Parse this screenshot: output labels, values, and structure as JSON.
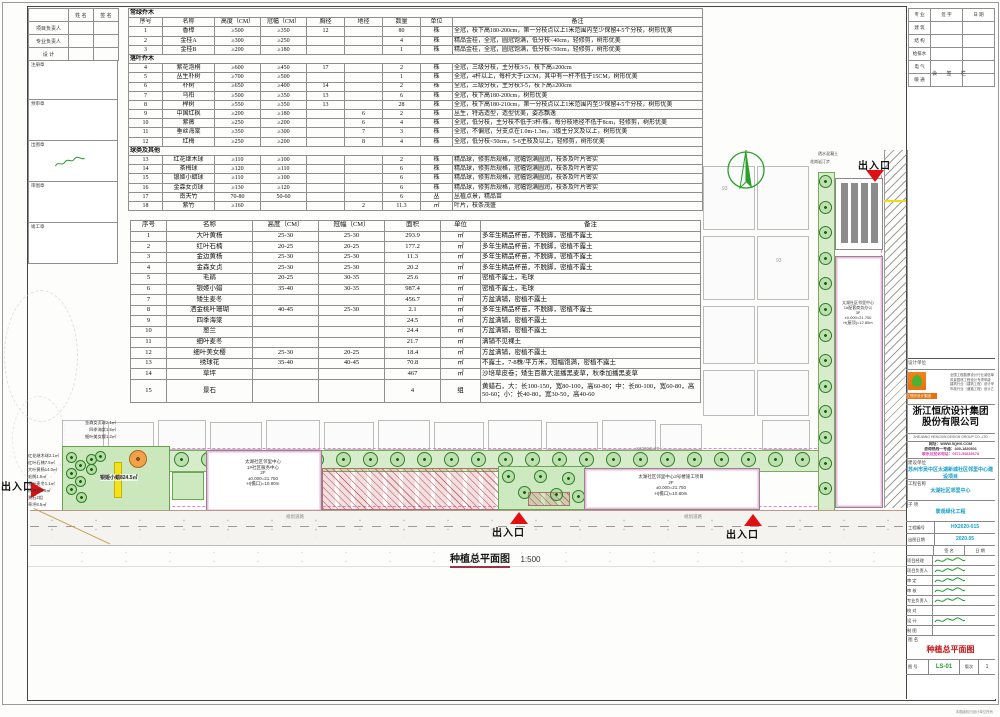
{
  "sheet": {
    "left_panel": {
      "headers": [
        "姓 名",
        "签 名"
      ],
      "rows": [
        "项目负责人",
        "专业负责人",
        "设  计"
      ],
      "stamps": [
        "注册章",
        "预审章",
        "出图章",
        "审图章",
        "竣工章"
      ]
    },
    "plant_table": {
      "headers": [
        "序号",
        "名称",
        "高度（CM）",
        "冠幅（CM）",
        "胸径",
        "地径",
        "数量",
        "单位",
        "备注"
      ],
      "sections": [
        {
          "title": "常绿乔木",
          "rows": [
            [
              "1",
              "香樟",
              "≥500",
              "≥350",
              "12",
              "",
              "80",
              "株",
              "全冠，枝下高180-200cm，第一分枝点以上1米范围内至少保留4-5个分枝，树形优美"
            ],
            [
              "2",
              "金桂A",
              "≥300",
              "≥250",
              "",
              "",
              "4",
              "株",
              "精品金桂，全冠，圆冠饱满，低分枝<40cm，轻修剪，树形优美"
            ],
            [
              "3",
              "金桂B",
              "≥200",
              "≥180",
              "",
              "",
              "1",
              "株",
              "精品金桂，全冠，圆冠饱满，低分枝<50cm，轻修剪，树形优美"
            ]
          ]
        },
        {
          "title": "落叶乔木",
          "rows": [
            [
              "4",
              "紫花泡桐",
              "≥600",
              "≥450",
              "17",
              "",
              "2",
              "株",
              "全冠，三级分枝，主分枝3-5，枝下高≥200cm"
            ],
            [
              "5",
              "丛生朴树",
              "≥700",
              "≥500",
              "",
              "",
              "1",
              "株",
              "全冠，4杆以上，每杆大于12CM，其中有一杆不低于15CM，树形优美"
            ],
            [
              "6",
              "朴树",
              "≥650",
              "≥400",
              "14",
              "",
              "2",
              "株",
              "全冠，三级分枝，主分枝3-5，枝下高≥200cm"
            ],
            [
              "7",
              "乌桕",
              "≥500",
              "≥350",
              "13",
              "",
              "6",
              "株",
              "全冠，枝下高180-200cm，树形优美"
            ],
            [
              "8",
              "榉树",
              "≥550",
              "≥350",
              "13",
              "",
              "28",
              "株",
              "全冠，枝下高180-210cm，第一分枝点以上1米范围内至少保留4-5个分枝，树形优美"
            ],
            [
              "9",
              "中国红枫",
              "≥200",
              "≥180",
              "",
              "6",
              "2",
              "株",
              "丛生，特选造型，造型优美，姿态飘逸"
            ],
            [
              "10",
              "紫薇",
              "≥250",
              "≥200",
              "",
              "6",
              "4",
              "株",
              "全冠，低分枝，主分枝不低于3杆/株，每分枝地径不低于8cm，轻修剪，树形优美"
            ],
            [
              "11",
              "垂丝海棠",
              "≥350",
              "≥300",
              "",
              "7",
              "3",
              "株",
              "全冠，不偏冠，分支点在1.0m-1.3m，3级主分叉及以上，树形优美"
            ],
            [
              "12",
              "红梅",
              "≥250",
              "≥200",
              "",
              "8",
              "4",
              "株",
              "全冠，低分枝<50cm，5-6主枝及以上，轻修剪，树形优美"
            ]
          ]
        },
        {
          "title": "球类及其他",
          "rows": [
            [
              "13",
              "红花继木球",
              "≥110",
              "≥100",
              "",
              "",
              "2",
              "株",
              "精品球，修剪后规格，冠幅饱满圆润，枝条及叶片密实"
            ],
            [
              "14",
              "茶梅球",
              "≥120",
              "≥110",
              "",
              "",
              "6",
              "株",
              "精品球，修剪后规格，冠幅饱满圆润，枝条及叶片密实"
            ],
            [
              "15",
              "银姬小蜡球",
              "≥110",
              "≥100",
              "",
              "",
              "6",
              "株",
              "精品球，修剪后规格，冠幅饱满圆润，枝条及叶片密实"
            ],
            [
              "16",
              "金森女贞球",
              "≥130",
              "≥120",
              "",
              "",
              "6",
              "株",
              "精品球，修剪后规格，冠幅饱满圆润，枝条及叶片密实"
            ],
            [
              "17",
              "南天竹",
              "70-80",
              "50-60",
              "",
              "",
              "6",
              "丛",
              "丛植点景，精品苗"
            ],
            [
              "18",
              "紫竹",
              "≥160",
              "",
              "",
              "2",
              "11.3",
              "㎡",
              "叶片，枝条茂盛"
            ]
          ]
        }
      ]
    },
    "ground_table": {
      "headers": [
        "序号",
        "名称",
        "高度（CM）",
        "冠幅（CM）",
        "面积",
        "单位",
        "备注"
      ],
      "rows": [
        [
          "1",
          "大叶黄杨",
          "25-30",
          "25-30",
          "293.9",
          "㎡",
          "多年生精品杯苗，不脱脚，密植不露土"
        ],
        [
          "2",
          "红叶石楠",
          "20-25",
          "20-25",
          "177.2",
          "㎡",
          "多年生精品杯苗，不脱脚，密植不露土"
        ],
        [
          "3",
          "金边黄杨",
          "25-30",
          "25-30",
          "11.3",
          "㎡",
          "多年生精品杯苗，不脱脚，密植不露土"
        ],
        [
          "4",
          "金森女贞",
          "25-30",
          "25-30",
          "20.2",
          "㎡",
          "多年生精品杯苗，不脱脚，密植不露土"
        ],
        [
          "5",
          "毛鹃",
          "20-25",
          "30-35",
          "25.6",
          "㎡",
          "密植不露土，毛球"
        ],
        [
          "6",
          "银姬小蜡",
          "35-40",
          "30-35",
          "987.4",
          "㎡",
          "密植不露土，毛球"
        ],
        [
          "7",
          "矮生麦冬",
          "",
          "",
          "456.7",
          "㎡",
          "方盆满铺，密植不露土"
        ],
        [
          "8",
          "洒金桃叶珊瑚",
          "40-45",
          "25-30",
          "2.1",
          "㎡",
          "多年生精品杯苗，不脱脚，密植不露土"
        ],
        [
          "9",
          "四季海棠",
          "",
          "",
          "24.5",
          "㎡",
          "方盆满铺，密植不露土"
        ],
        [
          "10",
          "葱兰",
          "",
          "",
          "24.4",
          "㎡",
          "方盆满铺，密植不露土"
        ],
        [
          "11",
          "细叶麦冬",
          "",
          "",
          "21.7",
          "㎡",
          "满铺不见裸土"
        ],
        [
          "12",
          "细叶美女樱",
          "25-30",
          "20-25",
          "18.4",
          "㎡",
          "方盆满铺，密植不露土"
        ],
        [
          "13",
          "绣球花",
          "35-40",
          "40-45",
          "70.8",
          "㎡",
          "不露土，7-8株/平方米，冠幅饱满，密植不露土"
        ],
        [
          "14",
          "草坪",
          "",
          "",
          "467",
          "㎡",
          "沙培草皮卷；矮生百慕大混播黑麦草，秋季加播黑麦草"
        ],
        [
          "15",
          "景石",
          "",
          "",
          "4",
          "组",
          "黄蜡石，大：长100-150，宽80-100，高60-80；中：长80-100，宽60-80，高50-60；小：长40-80，宽30-50，高40-60"
        ]
      ]
    },
    "signoff": {
      "caption": "会 签 栏",
      "headers": [
        "专 业",
        "签 字",
        "日 期"
      ],
      "rows": [
        "建 筑",
        "结 构",
        "给排水",
        "电 气",
        "暖 通"
      ]
    },
    "title_block": {
      "design_unit_label": "设计单位",
      "logo_banner": "浙江恒欣设计集团",
      "company_cn_1": "浙江恒欣设计集团",
      "company_cn_2": "股份有限公司",
      "company_en": "ZHEJIANG HENGXIN DESIGN GROUP CO.,LTD",
      "cert_lines": [
        "全国工程勘察设计行业诚信单位",
        "风景园林工程设计专项甲级",
        "建筑行业（建筑工程）设计甲级",
        "市政行业（道路工程）设计乙级"
      ],
      "info_lines": [
        "网址：WWW.5QHX.COM",
        "咨询热线一号通：400-1820501"
      ],
      "hotline_line": "联系及投诉电话：0571-56835678",
      "fields_stacked": [
        {
          "label": "建设单位",
          "value": "苏州市吴中区太湖新城社区邻里中心建设项目"
        },
        {
          "label": "工程名称",
          "value": "太湖社区邻里中心"
        },
        {
          "label": "子  项",
          "value": "景观绿化工程"
        }
      ],
      "fields_inline": [
        {
          "label": "工程编号",
          "value": "HX2020-015"
        },
        {
          "label": "出图日期",
          "value": "2020.05"
        }
      ],
      "sign_headers": [
        "签  名",
        "日  期"
      ],
      "sign_rows": [
        "项目经理",
        "项目负责人",
        "审  定",
        "审  核",
        "专业负责人",
        "校  对",
        "设  计",
        "制  图"
      ],
      "drawing_name_label": "图  名",
      "drawing_name": "种植总平面图",
      "drawing_no_label": "图  号",
      "drawing_no": "LS-01",
      "rev_label": "版次",
      "rev_value": "1",
      "copyright_note": "本图版权归设计单位所有"
    }
  },
  "plan": {
    "title": "种植总平面图",
    "scale": "1:500",
    "entrance_label": "出入口",
    "building_a": [
      "太湖社区邻里中心",
      "1#社区服务中心",
      "2F",
      "±0.000=21.750",
      "H(檐口)=10.80m"
    ],
    "building_b": [
      "太湖社区邻里中心3号楼施工项目",
      "2F",
      "±0.000=21.750",
      "H(檐口)=10.80m"
    ],
    "building_c": [
      "太湖社区邻里中心",
      "1#配套商务办公",
      "3F",
      "±0.000=21.750",
      "H(屋顶)=12.80m"
    ],
    "road_label": "规划道路",
    "ref_label": "X3376Q-2B",
    "block_label": "93",
    "mid_label": "银姬小蜡824.5㎡",
    "top_left_labels": [
      "金森女贞球2.1㎡",
      "四季海棠1.5㎡",
      "细叶美女樱1.2㎡"
    ],
    "left_labels": [
      "红花继木球2.1㎡",
      "红叶石楠7.5㎡",
      "大叶黄杨14.0㎡",
      "毛鹃1.5㎡",
      "细叶麦冬1.1㎡",
      "绣球花8.5㎡",
      "景石2组",
      "草坪8.5㎡"
    ],
    "right_labels": [
      "透水混凝土",
      "花岗岩汀步"
    ]
  }
}
